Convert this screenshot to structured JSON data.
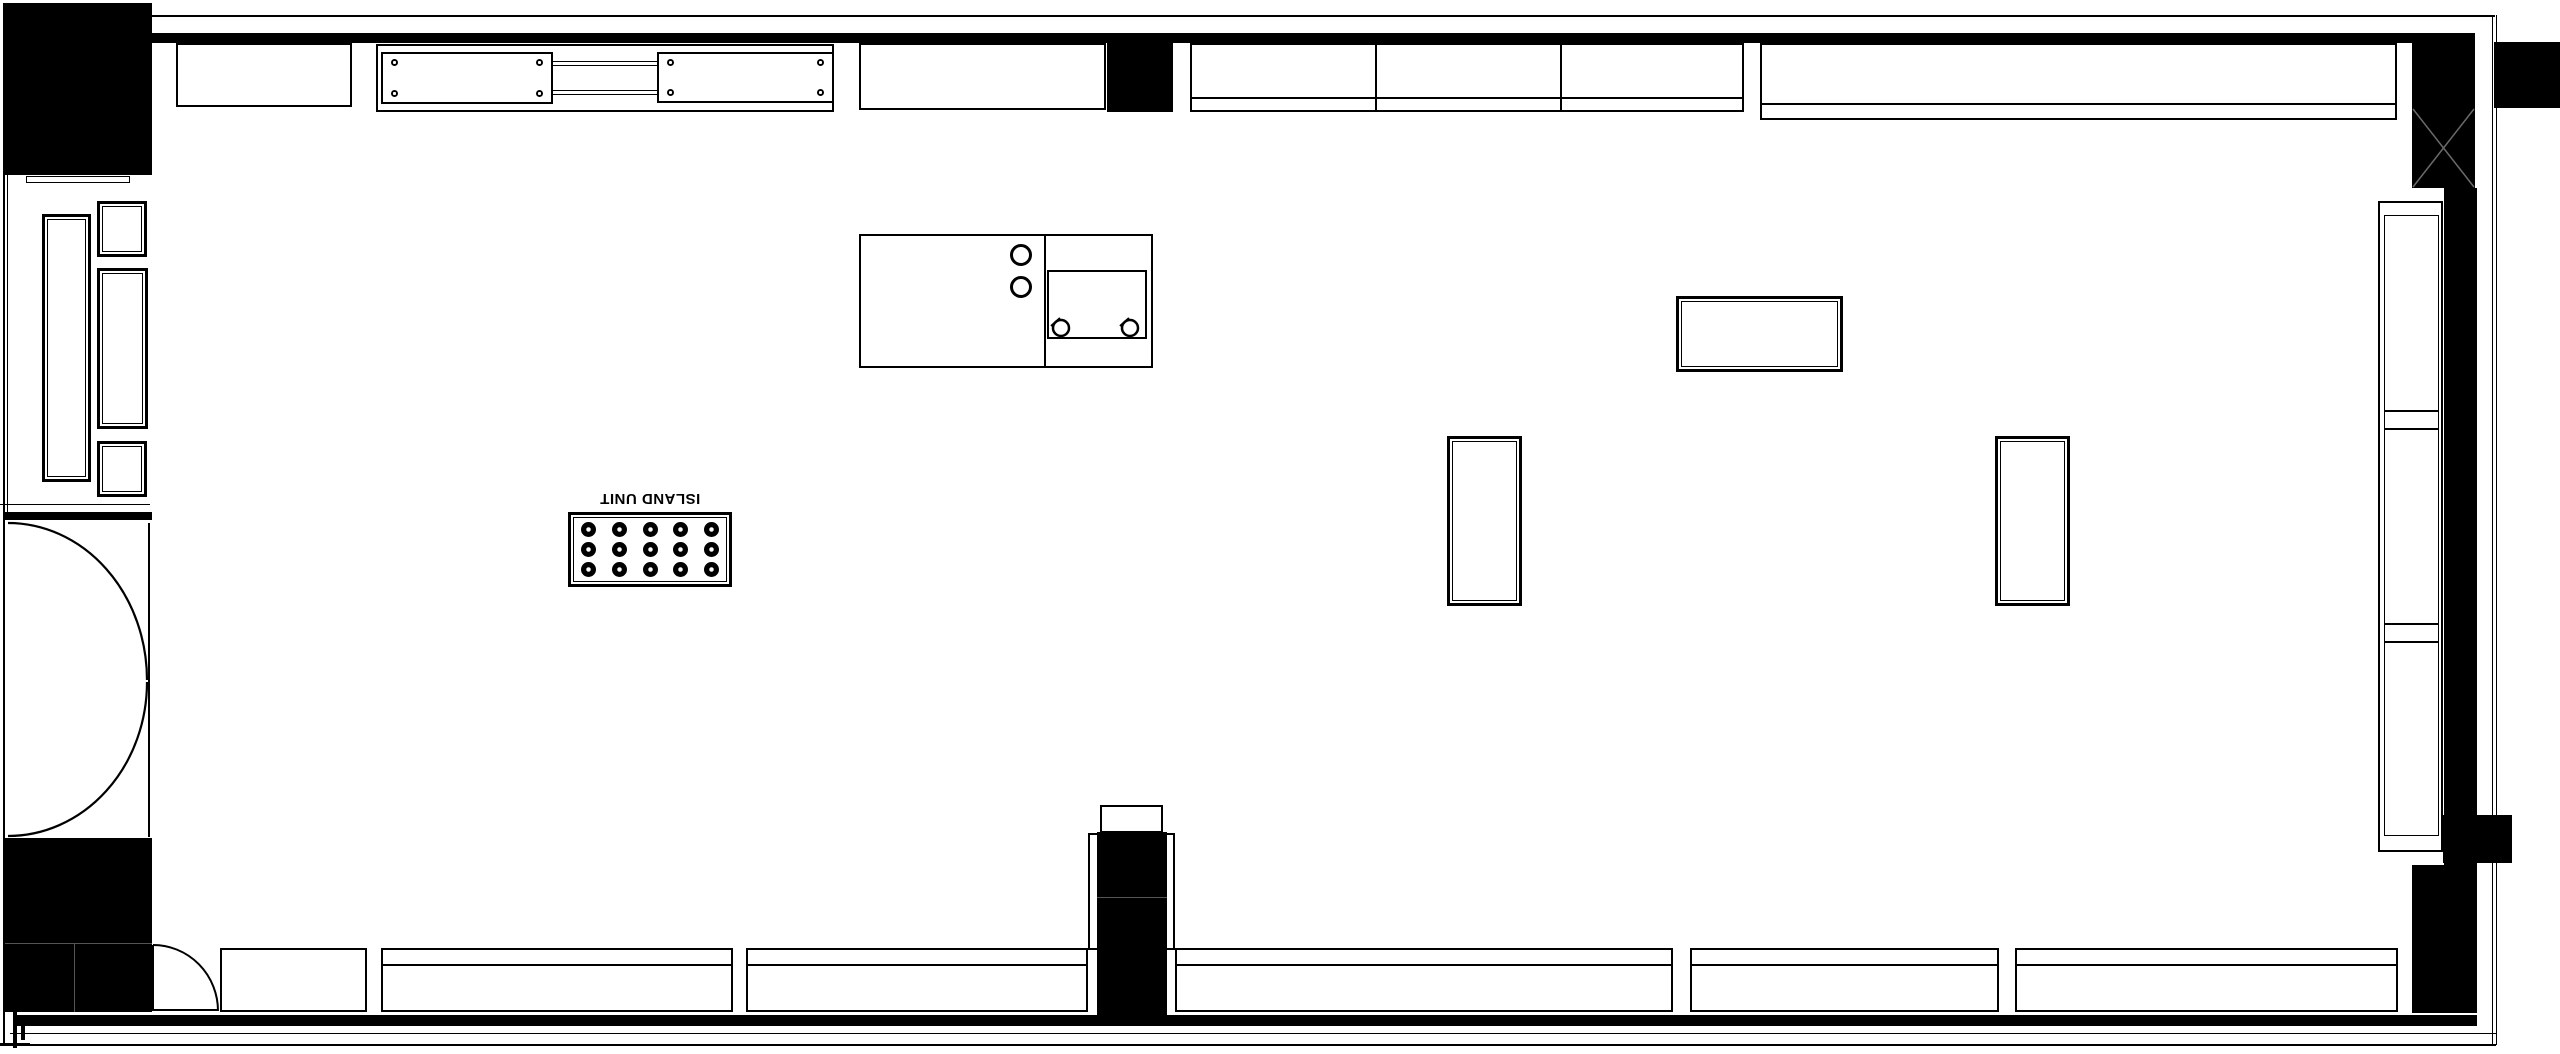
{
  "plan": {
    "type": "floor-plan",
    "background": "#ffffff",
    "wall_color": "#000000",
    "line_color": "#000000"
  },
  "fixtures": {
    "island_unit": {
      "label": "ISLAND UNIT",
      "label_rotation_deg": 180,
      "burner_rows": 3,
      "burner_cols": 5
    },
    "sink_unit": {
      "knob_circles": 2,
      "tap_circles": 2
    },
    "doors": {
      "double_door_left": "two quarter-circle swing arcs",
      "single_door_bottom": "quarter-circle swing arc"
    },
    "column_top_right": "x-braced-column"
  }
}
